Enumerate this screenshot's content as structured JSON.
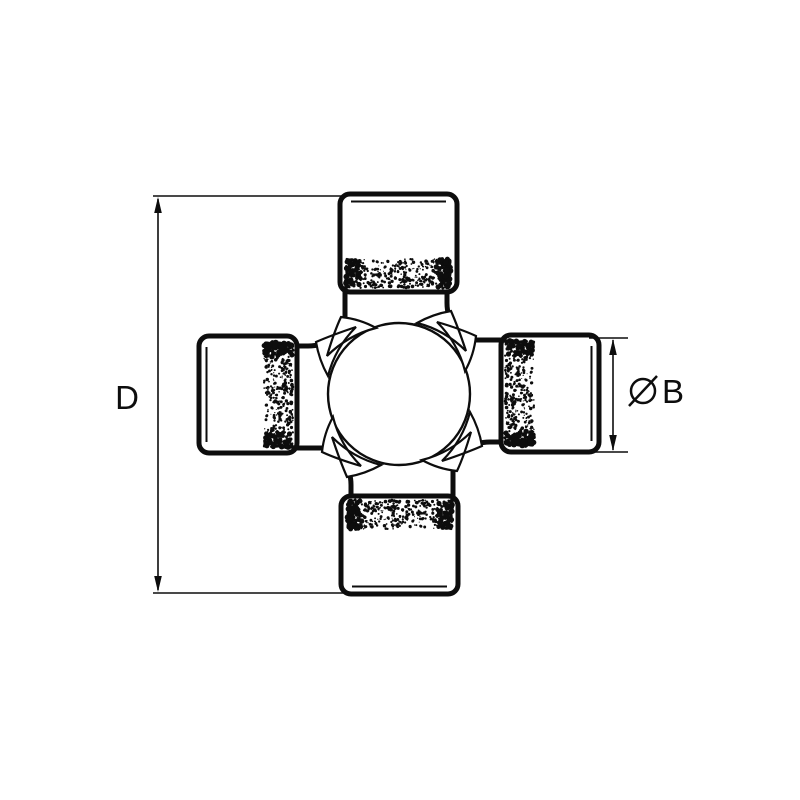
{
  "page": {
    "background_color": "#ffffff"
  },
  "drawing": {
    "type": "technical-line-drawing",
    "line_color": "#0d0d0d",
    "fill_color": "#ffffff",
    "parts": {
      "bearing_cap_count": 4,
      "seal_band_texture": "stipple"
    },
    "dimension_labels": {
      "overall": {
        "text": "D",
        "side": "left",
        "orientation": "vertical"
      },
      "cup_diameter": {
        "symbol": "Ø",
        "text": "B",
        "side": "right",
        "orientation": "vertical"
      }
    }
  }
}
